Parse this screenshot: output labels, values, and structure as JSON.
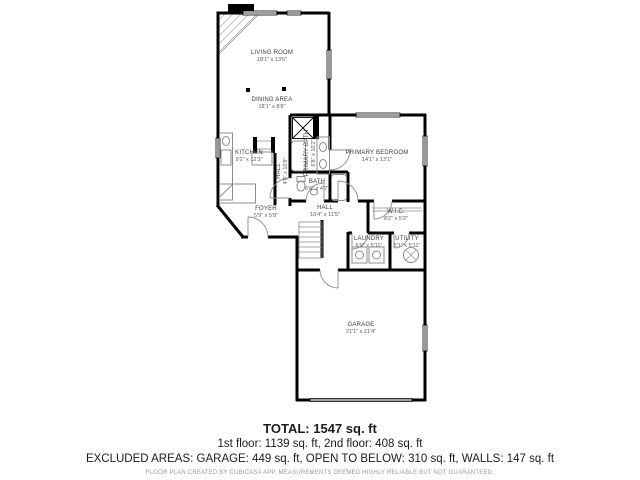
{
  "colors": {
    "walls": "#000000",
    "fixtures": "#8c8c8c",
    "label_text": "#3d3d3d",
    "disclaimer_text": "#9b9b9b"
  },
  "rooms": {
    "living_room": {
      "name": "LIVING ROOM",
      "dims": "18'1\" x 13'6\""
    },
    "dining_area": {
      "name": "DINING AREA",
      "dims": "18'1\" x 8'8\""
    },
    "kitchen": {
      "name": "KITCHEN",
      "dims": "9'2\" x 12'3\""
    },
    "foyer": {
      "name": "FOYER",
      "dims": "5'9\" x 5'9\""
    },
    "hall_small": {
      "name": "HALL",
      "dims": "4'0\" x 10'9\""
    },
    "primary_bath": {
      "name": "PRIMARY BATH",
      "dims": "6'8\" x 10'2\""
    },
    "primary_bedroom": {
      "name": "PRIMARY BEDROOM",
      "dims": "14'1\" x 13'1\""
    },
    "bath": {
      "name": "BATH",
      "dims": "6'6\" x 4'7\""
    },
    "hall": {
      "name": "HALL",
      "dims": "10'4\" x 11'5\""
    },
    "wic": {
      "name": "W.I.C.",
      "dims": "8'2\" x 5'2\""
    },
    "laundry": {
      "name": "LAUNDRY",
      "dims": "6'0\" x 5'11\""
    },
    "utility": {
      "name": "UTILITY",
      "dims": "5'1\" x 5'11\""
    },
    "garage": {
      "name": "GARAGE",
      "dims": "21'1\" x 21'4\""
    }
  },
  "summary": {
    "total": "TOTAL: 1547 sq. ft",
    "floors": "1st floor: 1139 sq. ft, 2nd floor: 408 sq. ft",
    "excluded": "EXCLUDED AREAS: GARAGE: 449 sq. ft, OPEN TO BELOW: 310 sq. ft, WALLS: 147 sq. ft",
    "disclaimer": "FLOOR PLAN CREATED BY CUBICASA APP. MEASUREMENTS DEEMED HIGHLY RELIABLE BUT NOT GUARANTEED."
  }
}
